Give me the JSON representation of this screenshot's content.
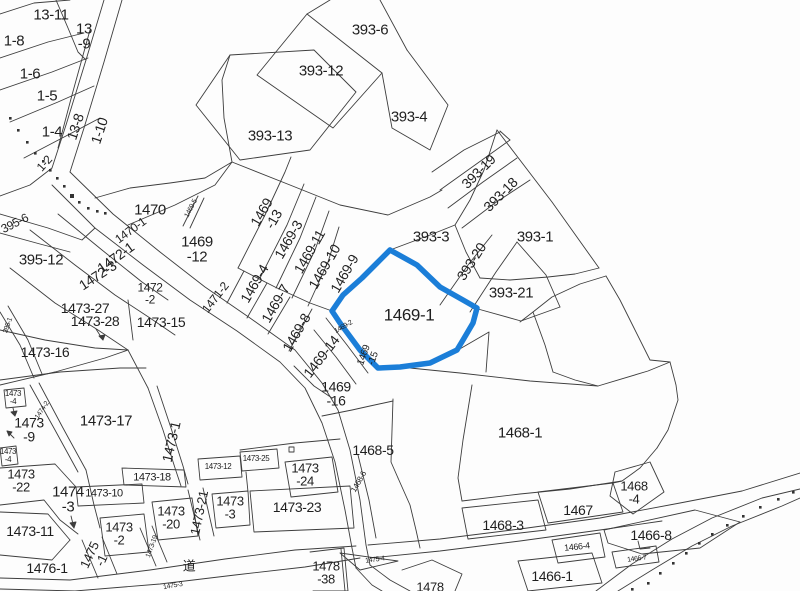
{
  "map": {
    "background": "#fdfdfd",
    "line_color": "#3d3d3d",
    "text_color": "#1f1f1f",
    "highlight": {
      "parcel_id": "1469-1",
      "color": "#1b7ed8",
      "stroke_width": 5.5
    },
    "road_kanji": "道",
    "labels": [
      {
        "t": "13-11",
        "x": 51,
        "y": 16,
        "r": 0,
        "s": 15
      },
      {
        "t": "13\n-9",
        "x": 84,
        "y": 37,
        "r": 0,
        "s": 15
      },
      {
        "t": "1-8",
        "x": 14,
        "y": 42,
        "r": 0,
        "s": 15
      },
      {
        "t": "1-6",
        "x": 30,
        "y": 75,
        "r": 0,
        "s": 15
      },
      {
        "t": "1-5",
        "x": 47,
        "y": 97,
        "r": 0,
        "s": 15
      },
      {
        "t": "1-4",
        "x": 52,
        "y": 133,
        "r": 0,
        "s": 15
      },
      {
        "t": "13-8",
        "x": 76,
        "y": 127,
        "r": -72,
        "s": 14
      },
      {
        "t": "1-10",
        "x": 100,
        "y": 131,
        "r": -72,
        "s": 14
      },
      {
        "t": "1-2",
        "x": 45,
        "y": 164,
        "r": -48,
        "s": 12
      },
      {
        "t": "393-6",
        "x": 370,
        "y": 31,
        "r": 0,
        "s": 15
      },
      {
        "t": "393-12",
        "x": 321,
        "y": 72,
        "r": 0,
        "s": 15
      },
      {
        "t": "393-13",
        "x": 270,
        "y": 137,
        "r": 0,
        "s": 15
      },
      {
        "t": "393-4",
        "x": 409,
        "y": 118,
        "r": 0,
        "s": 15
      },
      {
        "t": "393-19",
        "x": 479,
        "y": 172,
        "r": -45,
        "s": 14
      },
      {
        "t": "393-18",
        "x": 501,
        "y": 195,
        "r": -45,
        "s": 14
      },
      {
        "t": "393-3",
        "x": 431,
        "y": 238,
        "r": 0,
        "s": 15
      },
      {
        "t": "393-1",
        "x": 535,
        "y": 238,
        "r": 0,
        "s": 15
      },
      {
        "t": "393-20",
        "x": 472,
        "y": 262,
        "r": -57,
        "s": 14
      },
      {
        "t": "393-21",
        "x": 511,
        "y": 294,
        "r": 0,
        "s": 15
      },
      {
        "t": "1470",
        "x": 150,
        "y": 211,
        "r": 0,
        "s": 15
      },
      {
        "t": "1470-1",
        "x": 131,
        "y": 231,
        "r": -36,
        "s": 12
      },
      {
        "t": "1469-5",
        "x": 192,
        "y": 209,
        "r": -62,
        "s": 7
      },
      {
        "t": "1469\n-13",
        "x": 268,
        "y": 216,
        "r": -60,
        "s": 14
      },
      {
        "t": "1469\n-12",
        "x": 197,
        "y": 250,
        "r": 0,
        "s": 15
      },
      {
        "t": "1469-3",
        "x": 289,
        "y": 240,
        "r": -60,
        "s": 14
      },
      {
        "t": "1469-11",
        "x": 310,
        "y": 252,
        "r": -60,
        "s": 14
      },
      {
        "t": "1469-10",
        "x": 325,
        "y": 267,
        "r": -60,
        "s": 14
      },
      {
        "t": "1469-9",
        "x": 345,
        "y": 274,
        "r": -60,
        "s": 14
      },
      {
        "t": "1469-4",
        "x": 255,
        "y": 284,
        "r": -60,
        "s": 14
      },
      {
        "t": "1469-7",
        "x": 276,
        "y": 304,
        "r": -60,
        "s": 14
      },
      {
        "t": "1469-8",
        "x": 297,
        "y": 333,
        "r": -60,
        "s": 14
      },
      {
        "t": "1469-14",
        "x": 322,
        "y": 357,
        "r": -52,
        "s": 14
      },
      {
        "t": "1469-2",
        "x": 344,
        "y": 328,
        "r": -30,
        "s": 7
      },
      {
        "t": "1469\n-15",
        "x": 369,
        "y": 357,
        "r": -70,
        "s": 10
      },
      {
        "t": "1469\n-16",
        "x": 336,
        "y": 394,
        "r": 0,
        "s": 14
      },
      {
        "t": "1469-1",
        "x": 409,
        "y": 316,
        "r": 0,
        "s": 17
      },
      {
        "t": "1472-1",
        "x": 116,
        "y": 258,
        "r": -36,
        "s": 14
      },
      {
        "t": "1472-3",
        "x": 98,
        "y": 276,
        "r": -33,
        "s": 14
      },
      {
        "t": "1472\n-2",
        "x": 150,
        "y": 294,
        "r": 0,
        "s": 12
      },
      {
        "t": "1471-2",
        "x": 216,
        "y": 298,
        "r": -52,
        "s": 12
      },
      {
        "t": "395-6",
        "x": 15,
        "y": 224,
        "r": -27,
        "s": 12
      },
      {
        "t": "395-12",
        "x": 41,
        "y": 261,
        "r": 0,
        "s": 15
      },
      {
        "t": "1473-27",
        "x": 85,
        "y": 309,
        "r": 0,
        "s": 14
      },
      {
        "t": "1473-28",
        "x": 95,
        "y": 322,
        "r": 0,
        "s": 14
      },
      {
        "t": "1473-15",
        "x": 161,
        "y": 323,
        "r": 0,
        "s": 14
      },
      {
        "t": "1473-16",
        "x": 45,
        "y": 353,
        "r": 0,
        "s": 14
      },
      {
        "t": "395-1",
        "x": 9,
        "y": 326,
        "r": -70,
        "s": 7
      },
      {
        "t": "1473\n-4",
        "x": 13,
        "y": 398,
        "r": 0,
        "s": 8
      },
      {
        "t": "1473\n-9",
        "x": 29,
        "y": 430,
        "r": 0,
        "s": 14
      },
      {
        "t": "1474-2",
        "x": 43,
        "y": 411,
        "r": -56,
        "s": 7
      },
      {
        "t": "1473-17",
        "x": 106,
        "y": 422,
        "r": 0,
        "s": 15
      },
      {
        "t": "1473-1",
        "x": 172,
        "y": 442,
        "r": -77,
        "s": 14
      },
      {
        "t": "1473\n-4",
        "x": 8,
        "y": 456,
        "r": 0,
        "s": 8
      },
      {
        "t": "1473\n-22",
        "x": 21,
        "y": 481,
        "r": 0,
        "s": 13
      },
      {
        "t": "1474\n-3",
        "x": 68,
        "y": 500,
        "r": 0,
        "s": 15
      },
      {
        "t": "1473-10",
        "x": 104,
        "y": 494,
        "r": 0,
        "s": 11
      },
      {
        "t": "1473-18",
        "x": 152,
        "y": 478,
        "r": 0,
        "s": 11
      },
      {
        "t": "1473-21",
        "x": 200,
        "y": 513,
        "r": -78,
        "s": 13
      },
      {
        "t": "1473-11",
        "x": 30,
        "y": 532,
        "r": 0,
        "s": 14
      },
      {
        "t": "1476-1",
        "x": 47,
        "y": 569,
        "r": 0,
        "s": 14
      },
      {
        "t": "1473\n-2",
        "x": 119,
        "y": 534,
        "r": 0,
        "s": 13
      },
      {
        "t": "1475\n-1",
        "x": 96,
        "y": 558,
        "r": -65,
        "s": 13
      },
      {
        "t": "1473-19",
        "x": 153,
        "y": 547,
        "r": -70,
        "s": 7
      },
      {
        "t": "1473\n-20",
        "x": 171,
        "y": 518,
        "r": 0,
        "s": 13
      },
      {
        "t": "道",
        "x": 189,
        "y": 567,
        "r": 0,
        "s": 13
      },
      {
        "t": "1475-3",
        "x": 173,
        "y": 587,
        "r": -10,
        "s": 7
      },
      {
        "t": "1473-12",
        "x": 218,
        "y": 467,
        "r": 0,
        "s": 8
      },
      {
        "t": "1473-25",
        "x": 256,
        "y": 459,
        "r": 0,
        "s": 8
      },
      {
        "t": "1473\n-24",
        "x": 305,
        "y": 475,
        "r": 0,
        "s": 13
      },
      {
        "t": "1473-23",
        "x": 297,
        "y": 508,
        "r": 0,
        "s": 14
      },
      {
        "t": "1473\n-3",
        "x": 230,
        "y": 508,
        "r": 0,
        "s": 13
      },
      {
        "t": "1478\n-38",
        "x": 326,
        "y": 573,
        "r": 0,
        "s": 13
      },
      {
        "t": "1468-5",
        "x": 373,
        "y": 451,
        "r": 0,
        "s": 14
      },
      {
        "t": "1468-6",
        "x": 359,
        "y": 482,
        "r": -60,
        "s": 8
      },
      {
        "t": "1475-4",
        "x": 375,
        "y": 561,
        "r": -8,
        "s": 7
      },
      {
        "t": "1478",
        "x": 430,
        "y": 588,
        "r": 0,
        "s": 13
      },
      {
        "t": "1468-1",
        "x": 520,
        "y": 434,
        "r": 0,
        "s": 15
      },
      {
        "t": "1468\n-4",
        "x": 634,
        "y": 493,
        "r": 0,
        "s": 13
      },
      {
        "t": "1467",
        "x": 578,
        "y": 511,
        "r": 0,
        "s": 14
      },
      {
        "t": "1468-3",
        "x": 503,
        "y": 526,
        "r": 0,
        "s": 14
      },
      {
        "t": "1466-8",
        "x": 651,
        "y": 536,
        "r": 0,
        "s": 14
      },
      {
        "t": "1466-4",
        "x": 577,
        "y": 547,
        "r": -6,
        "s": 9
      },
      {
        "t": "1466-7",
        "x": 637,
        "y": 560,
        "r": -8,
        "s": 7
      },
      {
        "t": "1466-1",
        "x": 552,
        "y": 577,
        "r": 0,
        "s": 14
      }
    ]
  }
}
